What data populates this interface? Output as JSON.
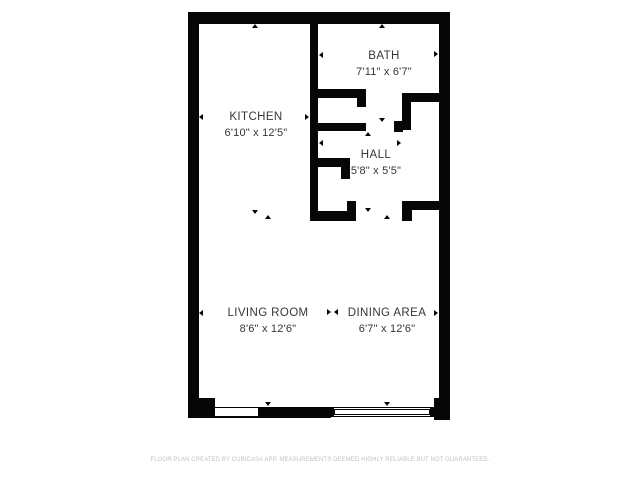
{
  "floorplan": {
    "rooms": {
      "kitchen": {
        "name": "KITCHEN",
        "dims": "6'10\" x 12'5\""
      },
      "bath": {
        "name": "BATH",
        "dims": "7'11\" x 6'7\""
      },
      "hall": {
        "name": "HALL",
        "dims": "5'8\" x 5'5\""
      },
      "living": {
        "name": "LIVING ROOM",
        "dims": "8'6\" x 12'6\""
      },
      "dining": {
        "name": "DINING AREA",
        "dims": "6'7\" x 12'6\""
      }
    },
    "wall_color": "#060606",
    "label_color": "#363636"
  },
  "footer": {
    "disclaimer": "FLOOR PLAN CREATED BY CUBICASA APP. MEASUREMENTS DEEMED HIGHLY RELIABLE BUT NOT GUARANTEED."
  }
}
